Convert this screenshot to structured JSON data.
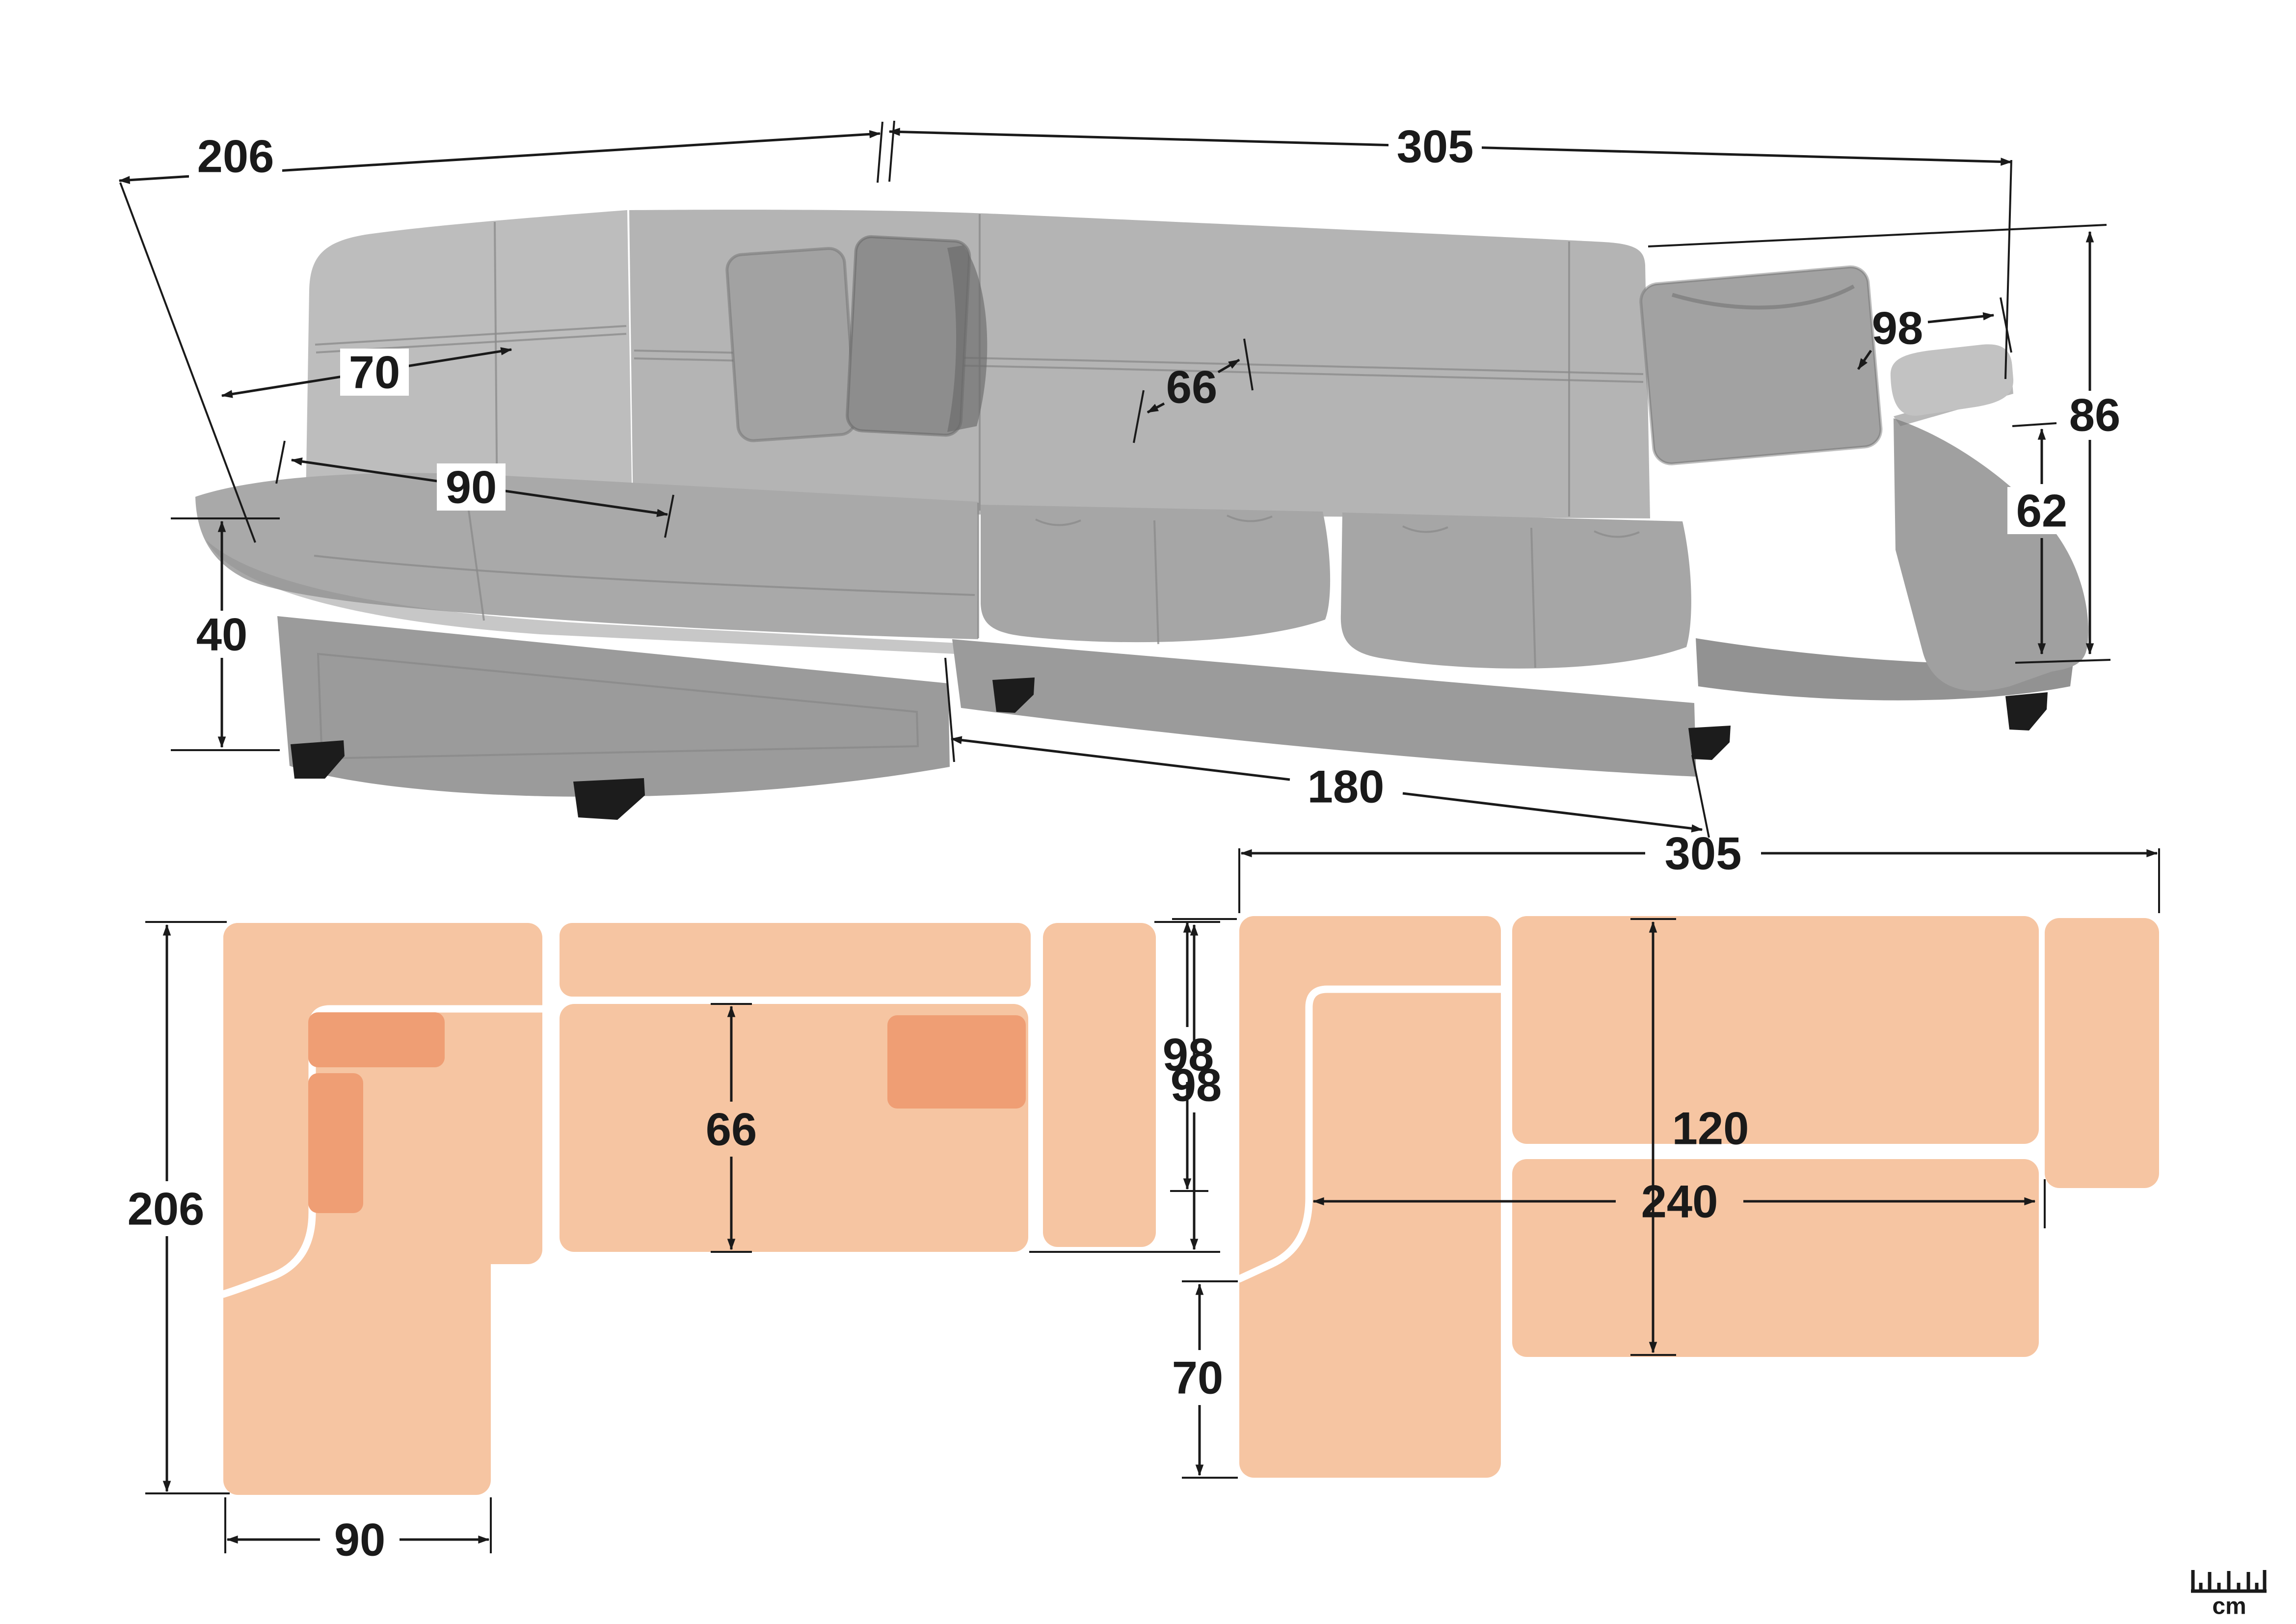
{
  "colors": {
    "peach_light": "#F6C5A2",
    "peach_dark": "#EF9E74",
    "line_color": "#1A1A1A",
    "sofa_back": "#B4B4B4",
    "sofa_back_light": "#BDBDBD",
    "sofa_seat": "#A9A9A9",
    "sofa_cushion": "#A6A6A6",
    "sofa_base": "#9B9B9B",
    "sofa_arm_side": "#A0A0A0",
    "sofa_arm_pad": "#C2C2C2",
    "pillow_mid": "#A2A2A2",
    "pillow_dark": "#8D8D8D",
    "leg_color": "#1C1C1C"
  },
  "photo_view": {
    "description": "grey corner sofa photograph with overall dimensions",
    "dims": {
      "back_width_left": "206",
      "back_width_right": "305",
      "backrest_depth": "70",
      "chaise_seat_width": "90",
      "seat_depth": "66",
      "seat_height": "40",
      "armrest_depth": "98",
      "total_height": "86",
      "armrest_height": "62",
      "front_seat_width": "180"
    }
  },
  "plan_sofa_view": {
    "description": "top view floor plan of sofa configuration",
    "dims": {
      "total_length": "206",
      "chaise_width": "90",
      "seat_depth": "66",
      "total_depth": "98"
    }
  },
  "plan_bed_view": {
    "description": "top view floor plan of sofa-bed configuration",
    "dims": {
      "total_width": "305",
      "module_depth": "98",
      "chaise_extension": "70",
      "bed_depth": "120",
      "bed_length": "240"
    }
  },
  "scale_icon": {
    "unit_label": "cm"
  }
}
